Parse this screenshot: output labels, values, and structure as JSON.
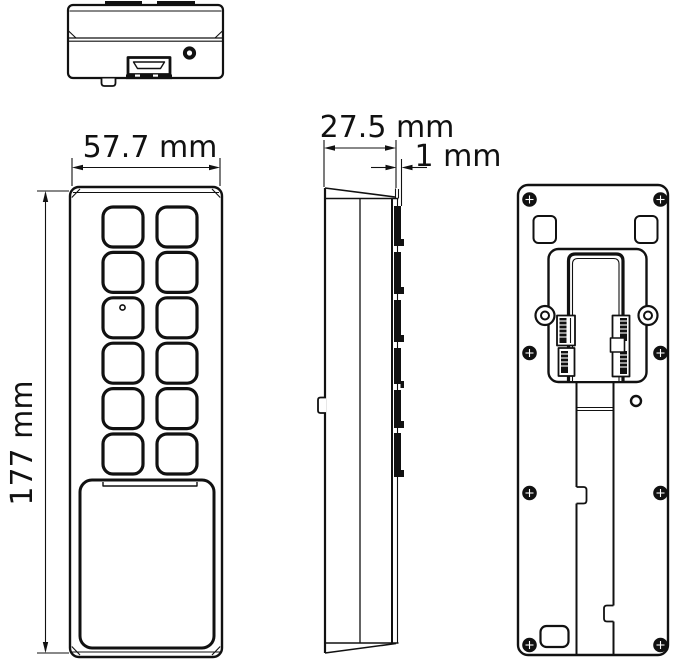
{
  "colors": {
    "line": "#111111",
    "background": "#ffffff"
  },
  "dimension_labels": {
    "front_width": "57.7 mm",
    "front_height": "177 mm",
    "side_depth": "27.5 mm",
    "side_lip": "1 mm"
  },
  "figure": {
    "keypad_button_rows": 6,
    "keypad_button_columns": 2,
    "views": [
      "top",
      "front",
      "side",
      "back"
    ]
  }
}
